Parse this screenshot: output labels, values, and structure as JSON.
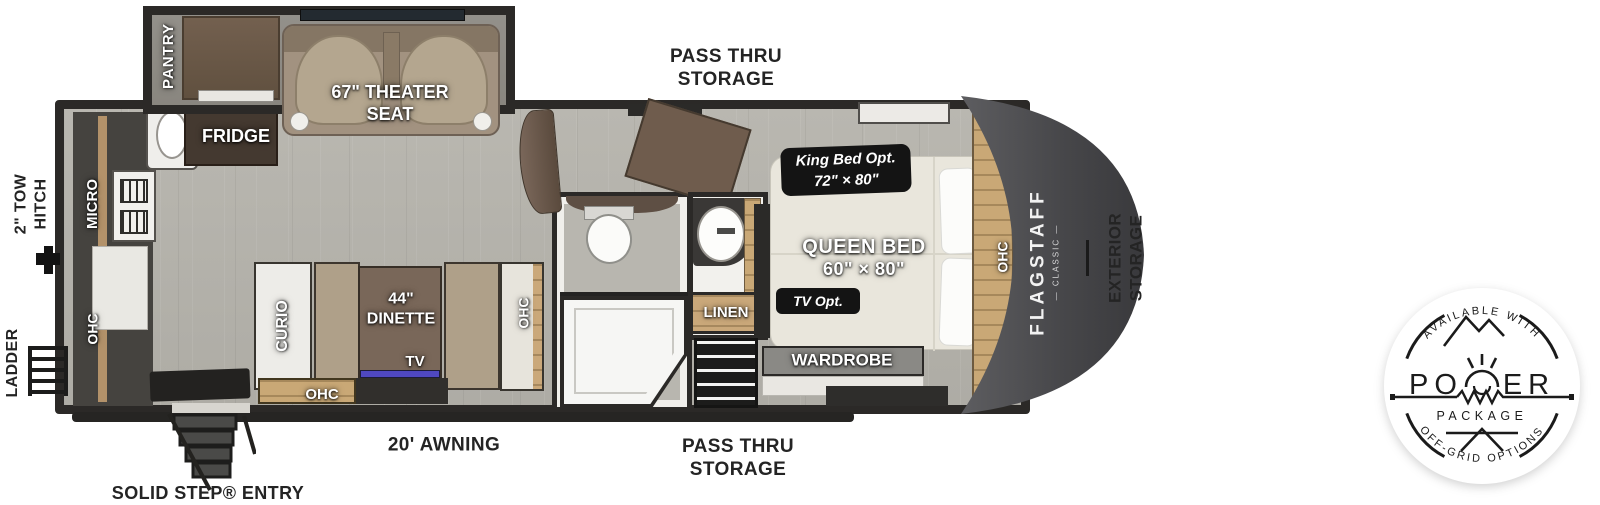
{
  "labels": {
    "pantry": "PANTRY",
    "fridge": "FRIDGE",
    "theater_seat": [
      "67\" THEATER",
      "SEAT"
    ],
    "micro": "MICRO",
    "ohc": "OHC",
    "curio": "CURIO",
    "dinette": [
      "44\"",
      "DINETTE"
    ],
    "tv": "TV",
    "linen": "LINEN",
    "wardrobe": "WARDROBE",
    "queen_bed": [
      "QUEEN BED",
      "60\" × 80\""
    ],
    "king_bed_badge": [
      "King Bed Opt.",
      "72\" × 80\""
    ],
    "tv_opt_badge": "TV Opt."
  },
  "exterior": {
    "tow_hitch": [
      "2\" TOW",
      "HITCH"
    ],
    "ladder": "LADDER",
    "pass_thru_top": [
      "PASS THRU",
      "STORAGE"
    ],
    "pass_thru_bottom": [
      "PASS THRU",
      "STORAGE"
    ],
    "awning": "20' AWNING",
    "entry": "SOLID STEP® ENTRY",
    "exterior_storage": [
      "EXTERIOR",
      "STORAGE"
    ]
  },
  "branding": {
    "name": "FLAGSTAFF",
    "series": "— CLASSIC —"
  },
  "power_badge": {
    "top_arc": "AVAILABLE WITH",
    "word_left": "PO",
    "word_right": "ER",
    "package": "PACKAGE",
    "bottom_arc": "OFF-GRID OPTIONS"
  },
  "colors": {
    "floor": "#b5b3ac",
    "walls": "#2b2927",
    "front_cap": "#4c4c4f",
    "wood_accent": "#c9a876",
    "cabinet_brown": "#6b584a",
    "badge_black": "#141414",
    "tv_screen": "#4f48c2"
  }
}
